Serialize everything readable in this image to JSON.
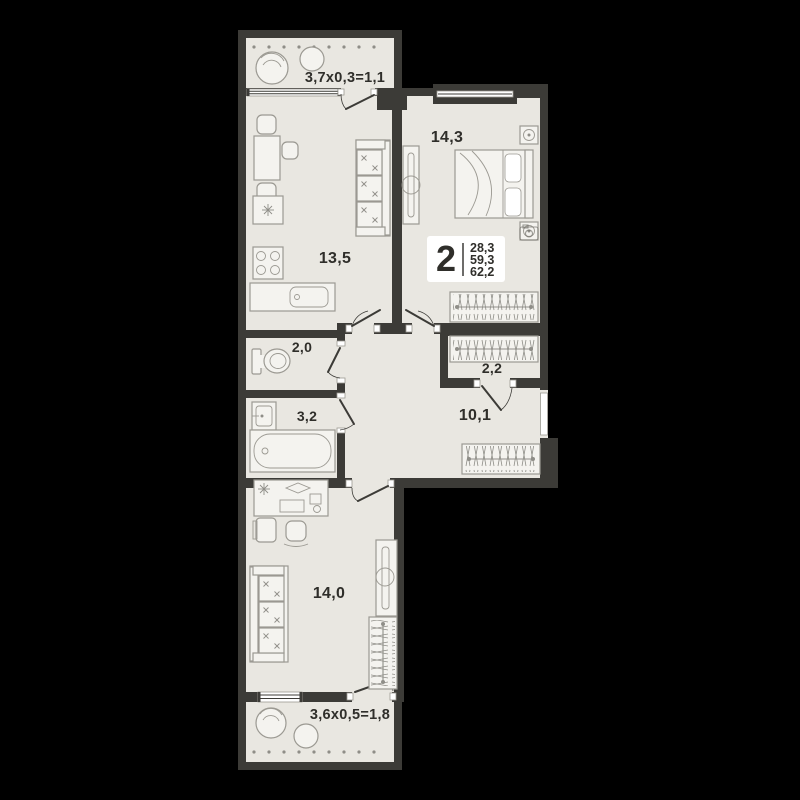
{
  "colors": {
    "background": "#000000",
    "wall": "#3c3b37",
    "floor": "#e9e7e1",
    "stroke": "#9b9992",
    "furnitureFill": "#f4f3ef",
    "hatch": "#8f8e88",
    "text": "#2f2e2a",
    "badgeBg": "#ffffff"
  },
  "plan": {
    "badge": {
      "rooms": "2",
      "values": [
        "28,3",
        "59,3",
        "62,2"
      ]
    },
    "labels": {
      "balcony_top": "3,7x0,3=1,1",
      "bedroom": "14,3",
      "kitchen_living": "13,5",
      "wc": "2,0",
      "bathroom": "3,2",
      "closet": "2,2",
      "hallway": "10,1",
      "room": "14,0",
      "balcony_bottom": "3,6x0,5=1,8"
    }
  }
}
